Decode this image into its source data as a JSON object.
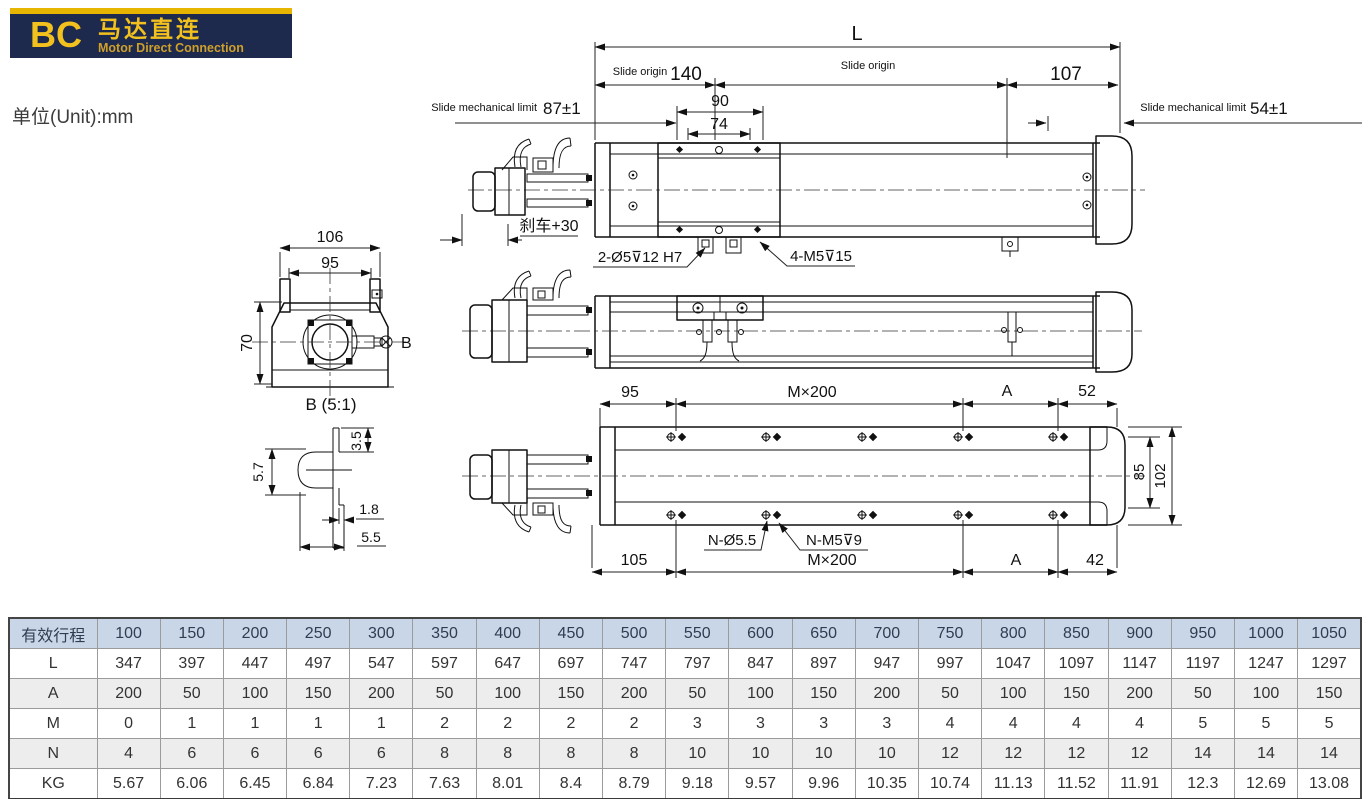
{
  "badge": {
    "code": "BC",
    "title_cn": "马达直连",
    "title_en": "Motor Direct Connection"
  },
  "page": {
    "unit_label": "单位(Unit):mm"
  },
  "colors": {
    "badge_navy": "#1d2a4e",
    "badge_yellow": "#f2c11d",
    "badge_stripe": "#e7b400",
    "table_header_bg": "#c9d6e8",
    "table_alt_row_bg": "#ededee"
  },
  "drawing": {
    "top_view": {
      "L": "L",
      "slide_origin_left": "Slide origin",
      "d140": "140",
      "slide_origin_right": "Slide origin",
      "d107": "107",
      "d90": "90",
      "d74": "74",
      "slide_limit_left_label": "Slide mechanical limit",
      "slide_limit_left_val": "87±1",
      "slide_limit_right_label": "Slide mechanical limit",
      "slide_limit_right_val": "54±1",
      "brake": "刹车+30",
      "callout_dowel": "2-Ø5⊽12 H7",
      "callout_tap": "4-M5⊽15"
    },
    "section_view": {
      "d106": "106",
      "d95": "95",
      "d70": "70",
      "label_b": "B"
    },
    "detail_b": {
      "title": "B (5:1)",
      "d3_5": "3.5",
      "d5_7": "5.7",
      "d1_8": "1.8",
      "d5_5": "5.5"
    },
    "bottom_view": {
      "d95": "95",
      "m200_top": "M×200",
      "a_top": "A",
      "d52": "52",
      "d105": "105",
      "m200_bottom": "M×200",
      "a_bottom": "A",
      "d42": "42",
      "d85": "85",
      "d102": "102",
      "callout_through": "N-Ø5.5",
      "callout_tap": "N-M5⊽9"
    }
  },
  "table": {
    "header": [
      "有效行程",
      "100",
      "150",
      "200",
      "250",
      "300",
      "350",
      "400",
      "450",
      "500",
      "550",
      "600",
      "650",
      "700",
      "750",
      "800",
      "850",
      "900",
      "950",
      "1000",
      "1050"
    ],
    "rows": [
      {
        "label": "L",
        "values": [
          "347",
          "397",
          "447",
          "497",
          "547",
          "597",
          "647",
          "697",
          "747",
          "797",
          "847",
          "897",
          "947",
          "997",
          "1047",
          "1097",
          "1147",
          "1197",
          "1247",
          "1297"
        ]
      },
      {
        "label": "A",
        "values": [
          "200",
          "50",
          "100",
          "150",
          "200",
          "50",
          "100",
          "150",
          "200",
          "50",
          "100",
          "150",
          "200",
          "50",
          "100",
          "150",
          "200",
          "50",
          "100",
          "150"
        ]
      },
      {
        "label": "M",
        "values": [
          "0",
          "1",
          "1",
          "1",
          "1",
          "2",
          "2",
          "2",
          "2",
          "3",
          "3",
          "3",
          "3",
          "4",
          "4",
          "4",
          "4",
          "5",
          "5",
          "5"
        ]
      },
      {
        "label": "N",
        "values": [
          "4",
          "6",
          "6",
          "6",
          "6",
          "8",
          "8",
          "8",
          "8",
          "10",
          "10",
          "10",
          "10",
          "12",
          "12",
          "12",
          "12",
          "14",
          "14",
          "14"
        ]
      },
      {
        "label": "KG",
        "values": [
          "5.67",
          "6.06",
          "6.45",
          "6.84",
          "7.23",
          "7.63",
          "8.01",
          "8.4",
          "8.79",
          "9.18",
          "9.57",
          "9.96",
          "10.35",
          "10.74",
          "11.13",
          "11.52",
          "11.91",
          "12.3",
          "12.69",
          "13.08"
        ]
      }
    ]
  }
}
